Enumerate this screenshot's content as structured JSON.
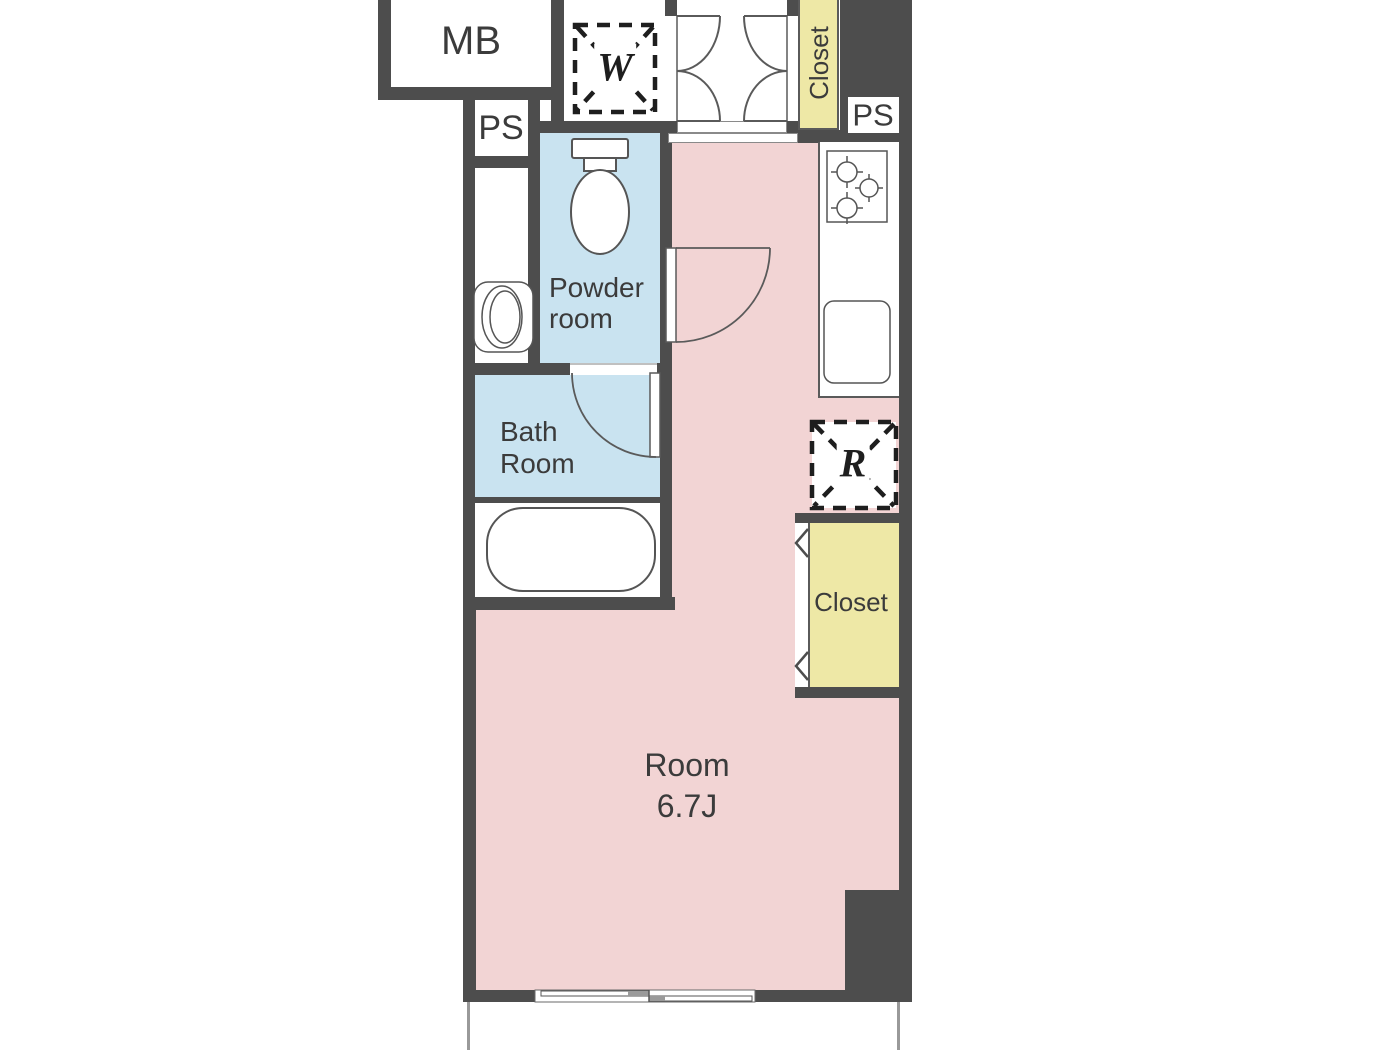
{
  "colors": {
    "wall": "#4d4d4d",
    "room_floor": "#f2d4d4",
    "wet_area_floor": "#c9e3f0",
    "closet_fill": "#eee8a6",
    "line": "#555555",
    "text": "#3b3b3b"
  },
  "labels": {
    "meter_box": "MB",
    "pipe_shaft_left": "PS",
    "pipe_shaft_right": "PS",
    "washing_machine": "W",
    "refrigerator": "R",
    "closet_top": "Closet",
    "closet_main": "Closet",
    "powder_room": {
      "line1": "Powder",
      "line2": "room"
    },
    "bath_room": {
      "line1": "Bath",
      "line2": "Room"
    },
    "main_room": {
      "name": "Room",
      "size": "6.7J"
    }
  }
}
